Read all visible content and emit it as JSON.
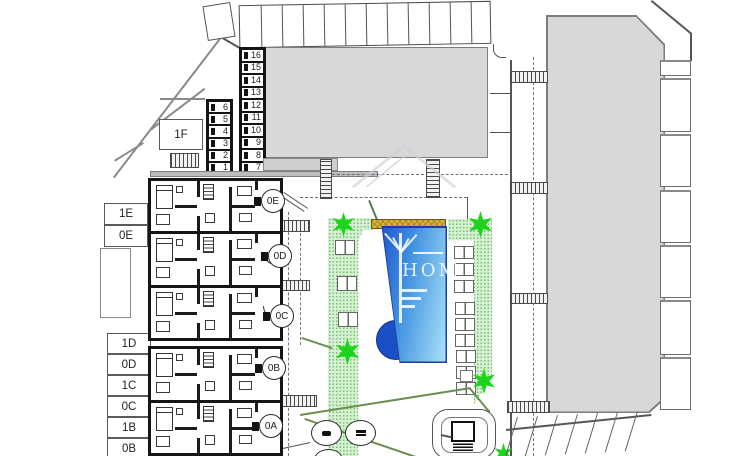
{
  "plan": {
    "watermark_text": "HOM",
    "annex_label": "1F",
    "storage_right": [
      "16",
      "15",
      "14",
      "13",
      "12",
      "11",
      "10",
      "9",
      "8",
      "7"
    ],
    "storage_left": [
      "6",
      "5",
      "4",
      "3",
      "2",
      "1"
    ],
    "labels_upper": [
      "1E",
      "0E"
    ],
    "labels_lower": [
      "1D",
      "0D",
      "1C",
      "0C",
      "1B",
      "0B"
    ],
    "unit_circles": [
      {
        "label": "0E"
      },
      {
        "label": "0D"
      },
      {
        "label": "0C"
      },
      {
        "label": "0B"
      },
      {
        "label": "0A"
      }
    ],
    "colors": {
      "building": "#d8d8d8",
      "lawn": "#d6f0d2",
      "pool_dark": "#1b4fc6",
      "pool_mid": "#3f8fe0",
      "pool_light": "#a9e3f8",
      "deck": "#d9b33c",
      "star": "#1dd41d"
    }
  }
}
